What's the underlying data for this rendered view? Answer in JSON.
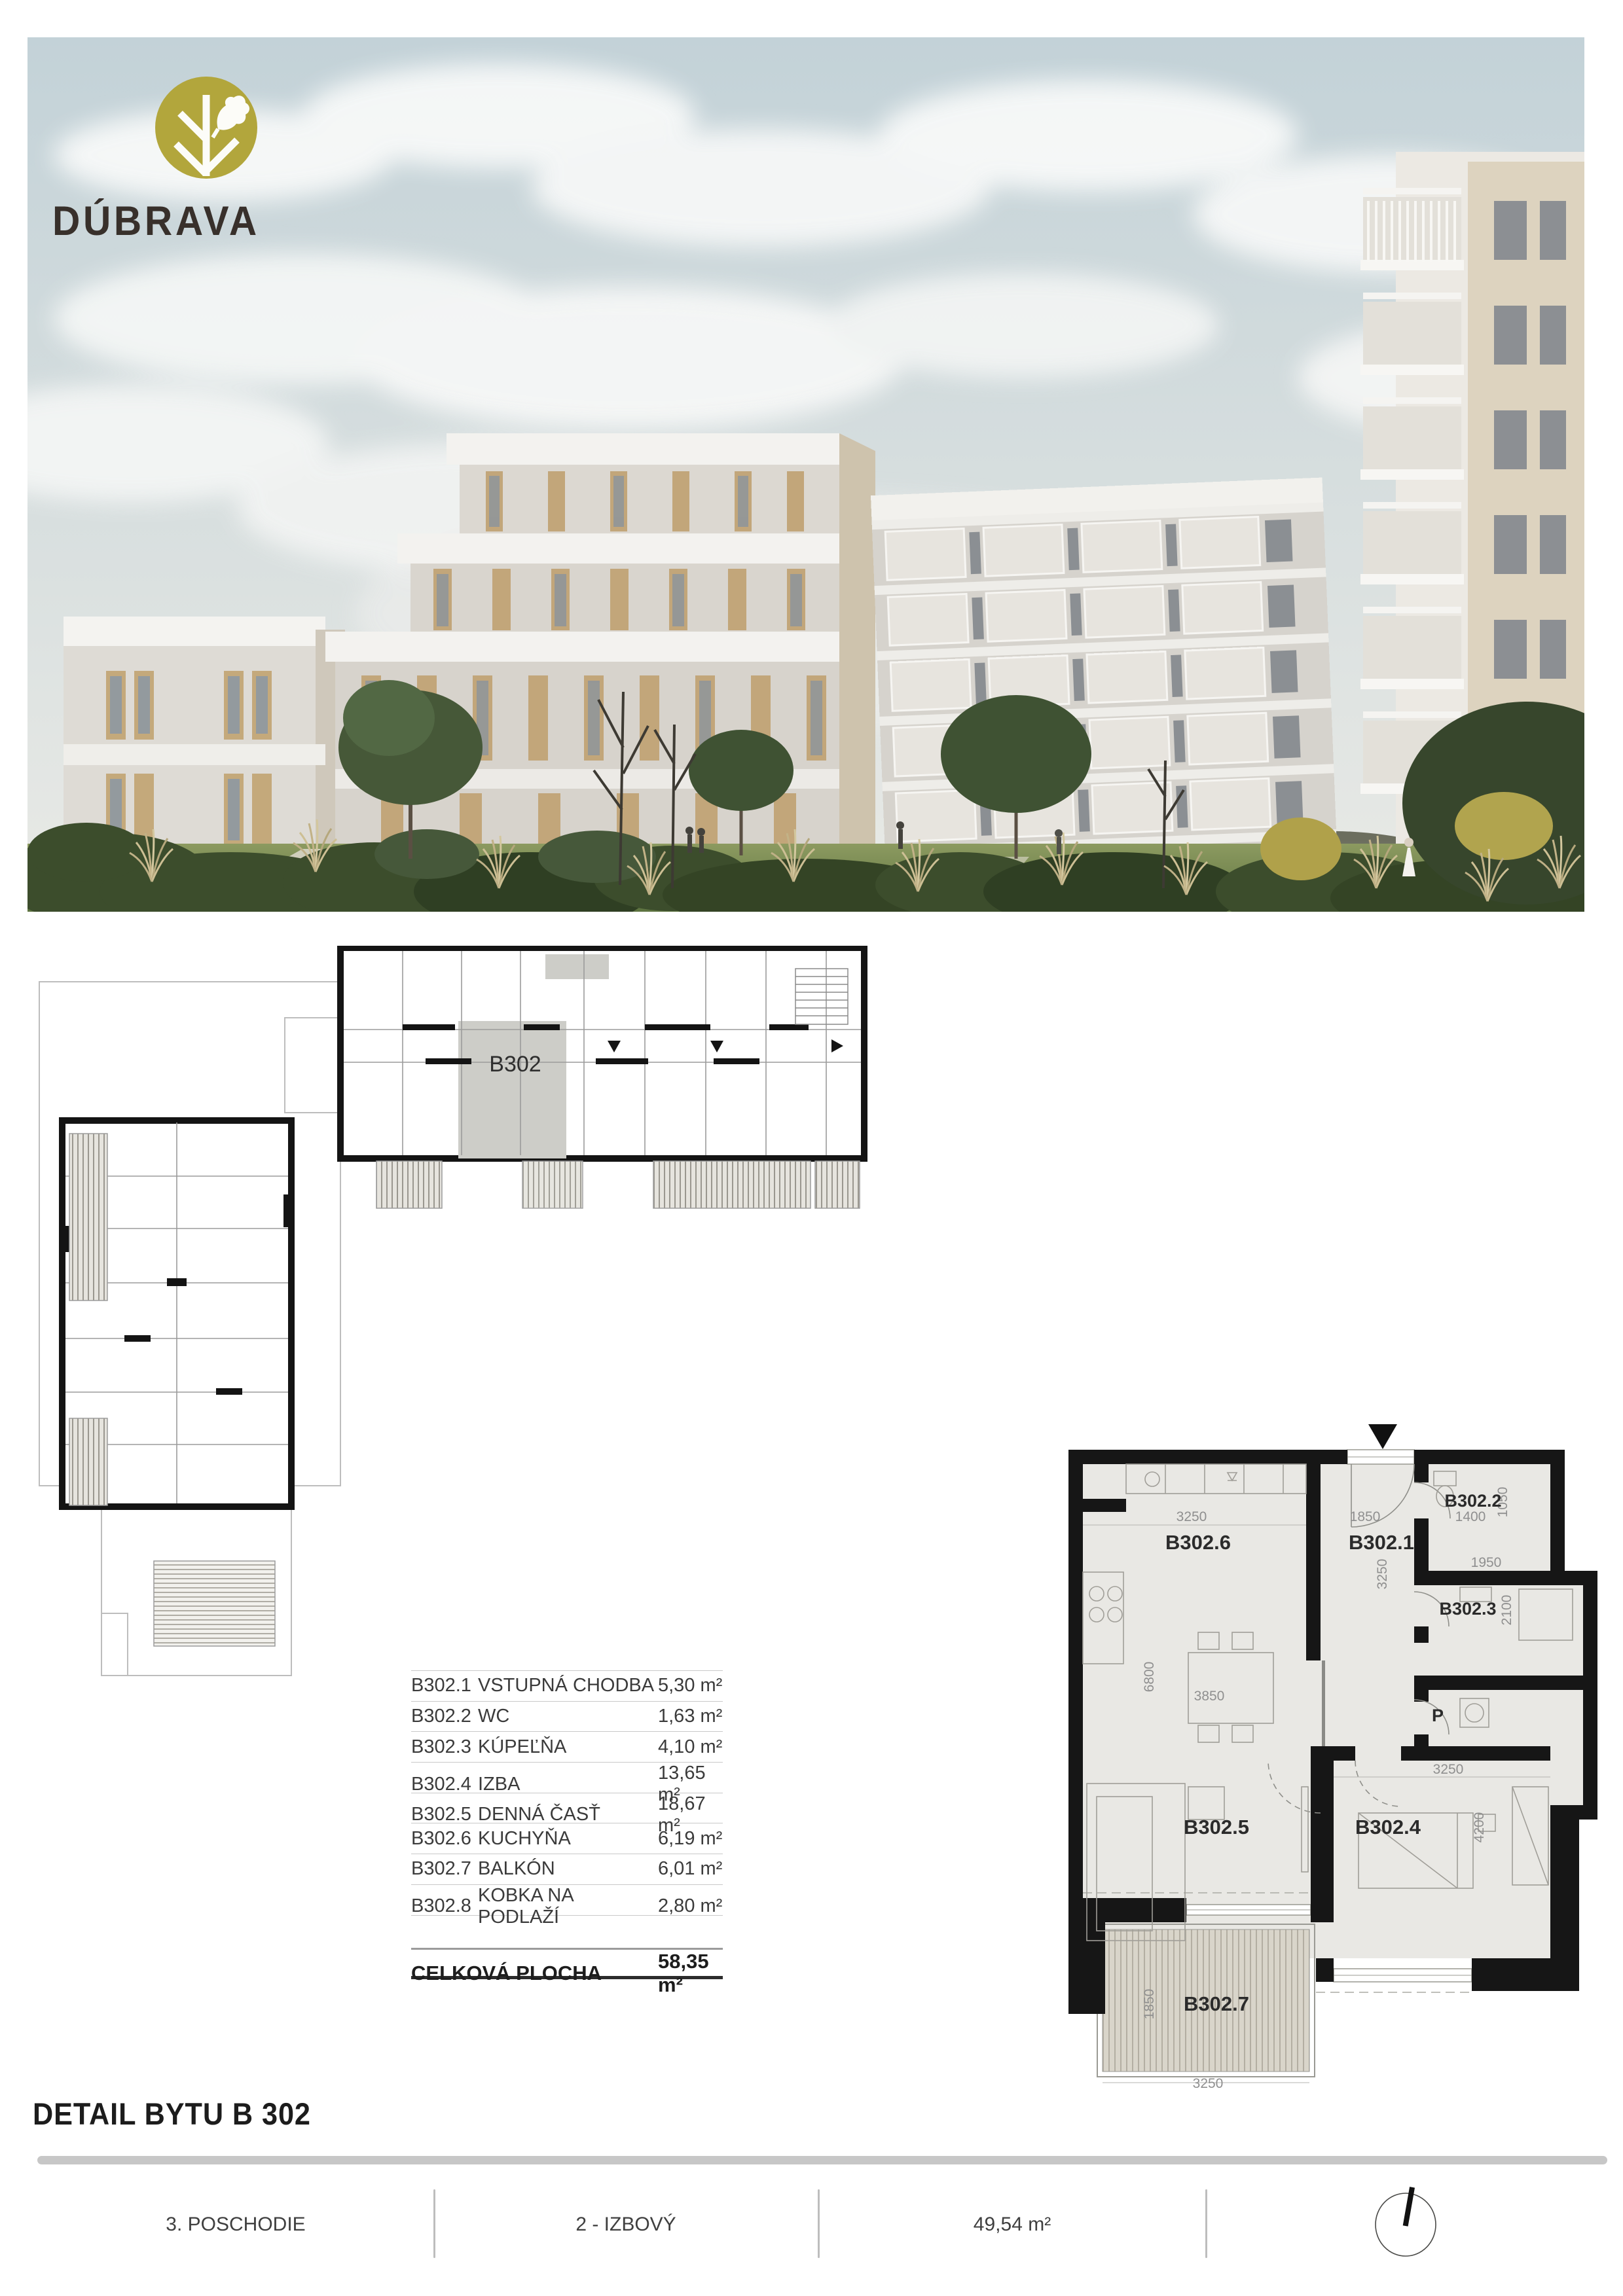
{
  "logo": {
    "brand": "DÚBRAVA",
    "icon": "oak-tree-icon",
    "colors": {
      "brand_olive": "#b2a63c",
      "logo_text": "#38302b"
    }
  },
  "hero": {
    "description_icon": "architectural-rendering"
  },
  "overview_plan": {
    "unit_label": "B302"
  },
  "detail_plan": {
    "rooms": [
      "B302.6",
      "B302.1",
      "B302.2",
      "B302.3",
      "P",
      "B302.5",
      "B302.4",
      "B302.7"
    ],
    "dims": [
      "3250",
      "1850",
      "1400",
      "1050",
      "1950",
      "3250",
      "2100",
      "6800",
      "3850",
      "3250",
      "4200",
      "1850",
      "3250"
    ]
  },
  "table": {
    "rows": [
      {
        "code": "B302.1",
        "name": "VSTUPNÁ CHODBA",
        "area": "5,30 m²"
      },
      {
        "code": "B302.2",
        "name": "WC",
        "area": "1,63 m²"
      },
      {
        "code": "B302.3",
        "name": "KÚPEĽŇA",
        "area": "4,10 m²"
      },
      {
        "code": "B302.4",
        "name": "IZBA",
        "area": "13,65 m²"
      },
      {
        "code": "B302.5",
        "name": "DENNÁ ČASŤ",
        "area": "18,67 m²"
      },
      {
        "code": "B302.6",
        "name": "KUCHYŇA",
        "area": "6,19 m²"
      },
      {
        "code": "B302.7",
        "name": "BALKÓN",
        "area": "6,01 m²"
      },
      {
        "code": "B302.8",
        "name": "KOBKA NA PODLAŽÍ",
        "area": "2,80 m²"
      }
    ],
    "total_label": "CELKOVÁ PLOCHA",
    "total_area": "58,35 m²"
  },
  "title": "DETAIL BYTU B 302",
  "footer": {
    "floor": "3. POSCHODIE",
    "layout": "2 - IZBOVÝ",
    "area": "49,54 m²",
    "compass_icon": "north-arrow-compass"
  },
  "colors": {
    "wall_black": "#161616",
    "plan_room_fill": "#e9e8e4",
    "balcony_fill": "#d9d5ca",
    "highlight_gray": "#cdcdc8",
    "rule_light": "#c9c9c9",
    "rule_dark": "#2c2c2c",
    "footer_bar": "#c7c7c7",
    "sky": "#c3d2d8"
  }
}
